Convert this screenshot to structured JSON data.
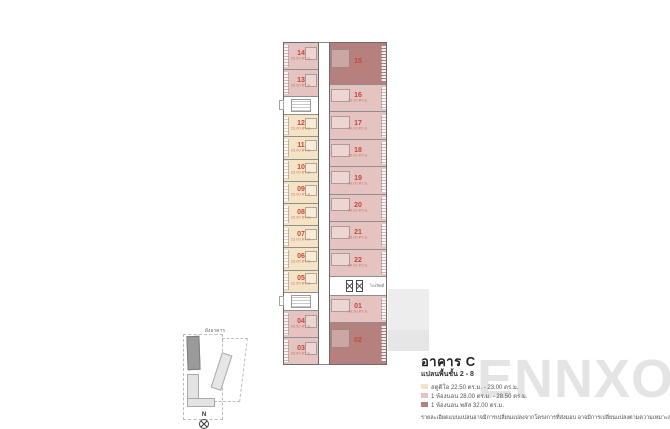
{
  "floorplan": {
    "unit_number_color": "#c8463a",
    "unit_area_color": "#c87a6e",
    "lift_lobby_label": "โถงลิฟต์",
    "left_stack": [
      {
        "kind": "unit",
        "no": "14",
        "area": "28.50 ตร.ม.",
        "type": "one-bed"
      },
      {
        "kind": "unit",
        "no": "13",
        "area": "28.50 ตร.ม.",
        "type": "one-bed"
      },
      {
        "kind": "stair-core"
      },
      {
        "kind": "unit",
        "no": "12",
        "area": "23.00 ตร.ม.",
        "type": "studio"
      },
      {
        "kind": "unit",
        "no": "11",
        "area": "23.00 ตร.ม.",
        "type": "studio"
      },
      {
        "kind": "unit",
        "no": "10",
        "area": "23.00 ตร.ม.",
        "type": "studio"
      },
      {
        "kind": "unit",
        "no": "09",
        "area": "23.00 ตร.ม.",
        "type": "studio"
      },
      {
        "kind": "unit",
        "no": "08",
        "area": "23.00 ตร.ม.",
        "type": "studio"
      },
      {
        "kind": "unit",
        "no": "07",
        "area": "23.00 ตร.ม.",
        "type": "studio"
      },
      {
        "kind": "unit",
        "no": "06",
        "area": "23.00 ตร.ม.",
        "type": "studio"
      },
      {
        "kind": "unit",
        "no": "05",
        "area": "22.50 ตร.ม.",
        "type": "studio"
      },
      {
        "kind": "stair-core"
      },
      {
        "kind": "unit",
        "no": "04",
        "area": "28.50 ตร.ม.",
        "type": "one-bed"
      },
      {
        "kind": "unit",
        "no": "03",
        "area": "28.50 ตร.ม.",
        "type": "one-bed"
      }
    ],
    "right_stack": [
      {
        "kind": "unit",
        "no": "15",
        "area": "32.00 ตร.ม.",
        "type": "one-bed-plus"
      },
      {
        "kind": "unit",
        "no": "16",
        "area": "28.00 ตร.ม.",
        "type": "one-bed"
      },
      {
        "kind": "unit",
        "no": "17",
        "area": "28.00 ตร.ม.",
        "type": "one-bed"
      },
      {
        "kind": "unit",
        "no": "18",
        "area": "28.00 ตร.ม.",
        "type": "one-bed"
      },
      {
        "kind": "unit",
        "no": "19",
        "area": "28.00 ตร.ม.",
        "type": "one-bed"
      },
      {
        "kind": "unit",
        "no": "20",
        "area": "28.00 ตร.ม.",
        "type": "one-bed"
      },
      {
        "kind": "unit",
        "no": "21",
        "area": "28.00 ตร.ม.",
        "type": "one-bed"
      },
      {
        "kind": "unit",
        "no": "22",
        "area": "28.00 ตร.ม.",
        "type": "one-bed"
      },
      {
        "kind": "lift-core"
      },
      {
        "kind": "unit",
        "no": "01",
        "area": "28.50 ตร.ม.",
        "type": "one-bed"
      },
      {
        "kind": "unit",
        "no": "02",
        "area": "32.00 ตร.ม.",
        "type": "one-bed-plus"
      }
    ]
  },
  "legend": {
    "title": "อาคาร C",
    "subtitle": "แปลนพื้นชั้น 2 - 8",
    "items": [
      {
        "type": "studio",
        "color": "#f5e3c6",
        "label": "สตูดิโอ 22.50 ตร.ม. - 23.00 ตร.ม."
      },
      {
        "type": "one-bed",
        "color": "#e4c3c0",
        "label": "1 ห้องนอน 28.00 ตร.ม. - 28.50 ตร.ม."
      },
      {
        "type": "one-bed-plus",
        "color": "#b5807d",
        "label": "1 ห้องนอน พลัส 32.00 ตร.ม."
      }
    ]
  },
  "watermark": "ENNXO",
  "disclaimer": "รายละเอียดแบบแปลนอาจมีการเปลี่ยนแปลงจากโครงการที่ส่งมอบ อาจมีการเปลี่ยนแปลงตามความเหมาะสม",
  "site_map": {
    "label": "ผังอาคาร",
    "compass_label": "N"
  }
}
